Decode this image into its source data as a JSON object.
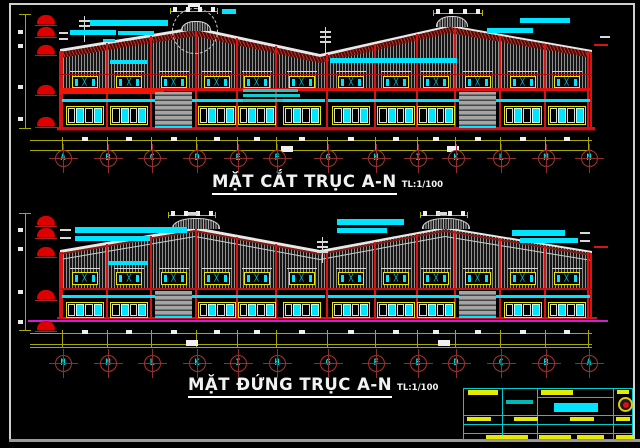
{
  "section_drawing": {
    "title": "MẶT CẮT TRỤC A-N",
    "scale": "TL:1/100",
    "grid_letters": [
      "A",
      "B",
      "C",
      "D",
      "E",
      "F",
      "G",
      "H",
      "I",
      "K",
      "L",
      "M",
      "N"
    ]
  },
  "elevation_drawing": {
    "title": "MẶT ĐỨNG TRỤC A-N",
    "scale": "TL:1/100",
    "grid_letters": [
      "N",
      "M",
      "L",
      "K",
      "I",
      "H",
      "G",
      "F",
      "E",
      "D",
      "C",
      "B",
      "A"
    ]
  },
  "glyphs": {
    "window_x_brace": "╳"
  },
  "colors": {
    "background": "#000000",
    "structure_red": "#d81414",
    "accent_cyan": "#00e5ff",
    "dim_yellow": "#a8a800",
    "grid_bubble_red": "#aa3333",
    "letter_cyan": "#00dddd",
    "hatch_gray": "#8f8f8f",
    "magenta_base": "#cc22cc",
    "door_gray": "#9e9e9e",
    "frame_white": "#cfcfcf",
    "title_white": "#f2f2f2",
    "marker_red": "#dd0000",
    "titleblock_yellow": "#e8e800"
  }
}
